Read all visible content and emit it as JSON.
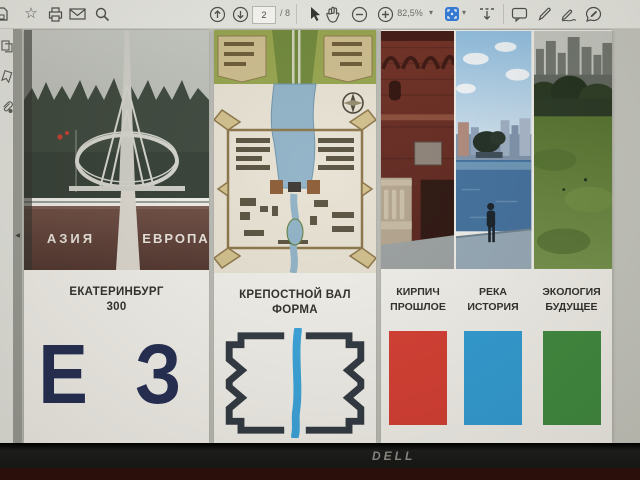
{
  "toolbar": {
    "page_current": "2",
    "page_total": "/ 8",
    "zoom_level": "82,5%",
    "dropdown_caret": "▾",
    "icon_names": [
      "save",
      "star",
      "print",
      "email",
      "search",
      "page-up",
      "page-down",
      "select-cursor",
      "hand-tool",
      "zoom-out",
      "zoom-in",
      "fit-page",
      "scroll-mode",
      "comment",
      "pencil",
      "sign",
      "fill-and-sign"
    ]
  },
  "sidebar": {
    "collapse_arrow": "◀",
    "icon_names": [
      "page-thumbnails",
      "bookmarks",
      "attachments"
    ]
  },
  "icons": {
    "star": "☆"
  },
  "document": {
    "boards": [
      {
        "title_line1": "ЕКАТЕРИНБУРГ",
        "title_line2": "300",
        "logo": "Е З",
        "photo_labels": {
          "left": "АЗИЯ",
          "right": "ЕВРОПА"
        }
      },
      {
        "title_line1": "КРЕПОСТНОЙ ВАЛ",
        "title_line2": "ФОРМА"
      },
      {
        "columns": [
          {
            "title_line1": "КИРПИЧ",
            "title_line2": "ПРОШЛОЕ",
            "swatch_color": "#d63b30"
          },
          {
            "title_line1": "РЕКА",
            "title_line2": "ИСТОРИЯ",
            "swatch_color": "#2d9cd6"
          },
          {
            "title_line1": "ЭКОЛОГИЯ",
            "title_line2": "БУДУЩЕЕ",
            "swatch_color": "#3c8a3e"
          }
        ]
      }
    ]
  },
  "monitor": {
    "brand": "DELL"
  },
  "colors": {
    "accent_blue": "#2e7ce0",
    "logo_navy": "#202a52",
    "fortress_icon_dark": "#2c3540",
    "fortress_icon_river": "#36a3dd"
  }
}
